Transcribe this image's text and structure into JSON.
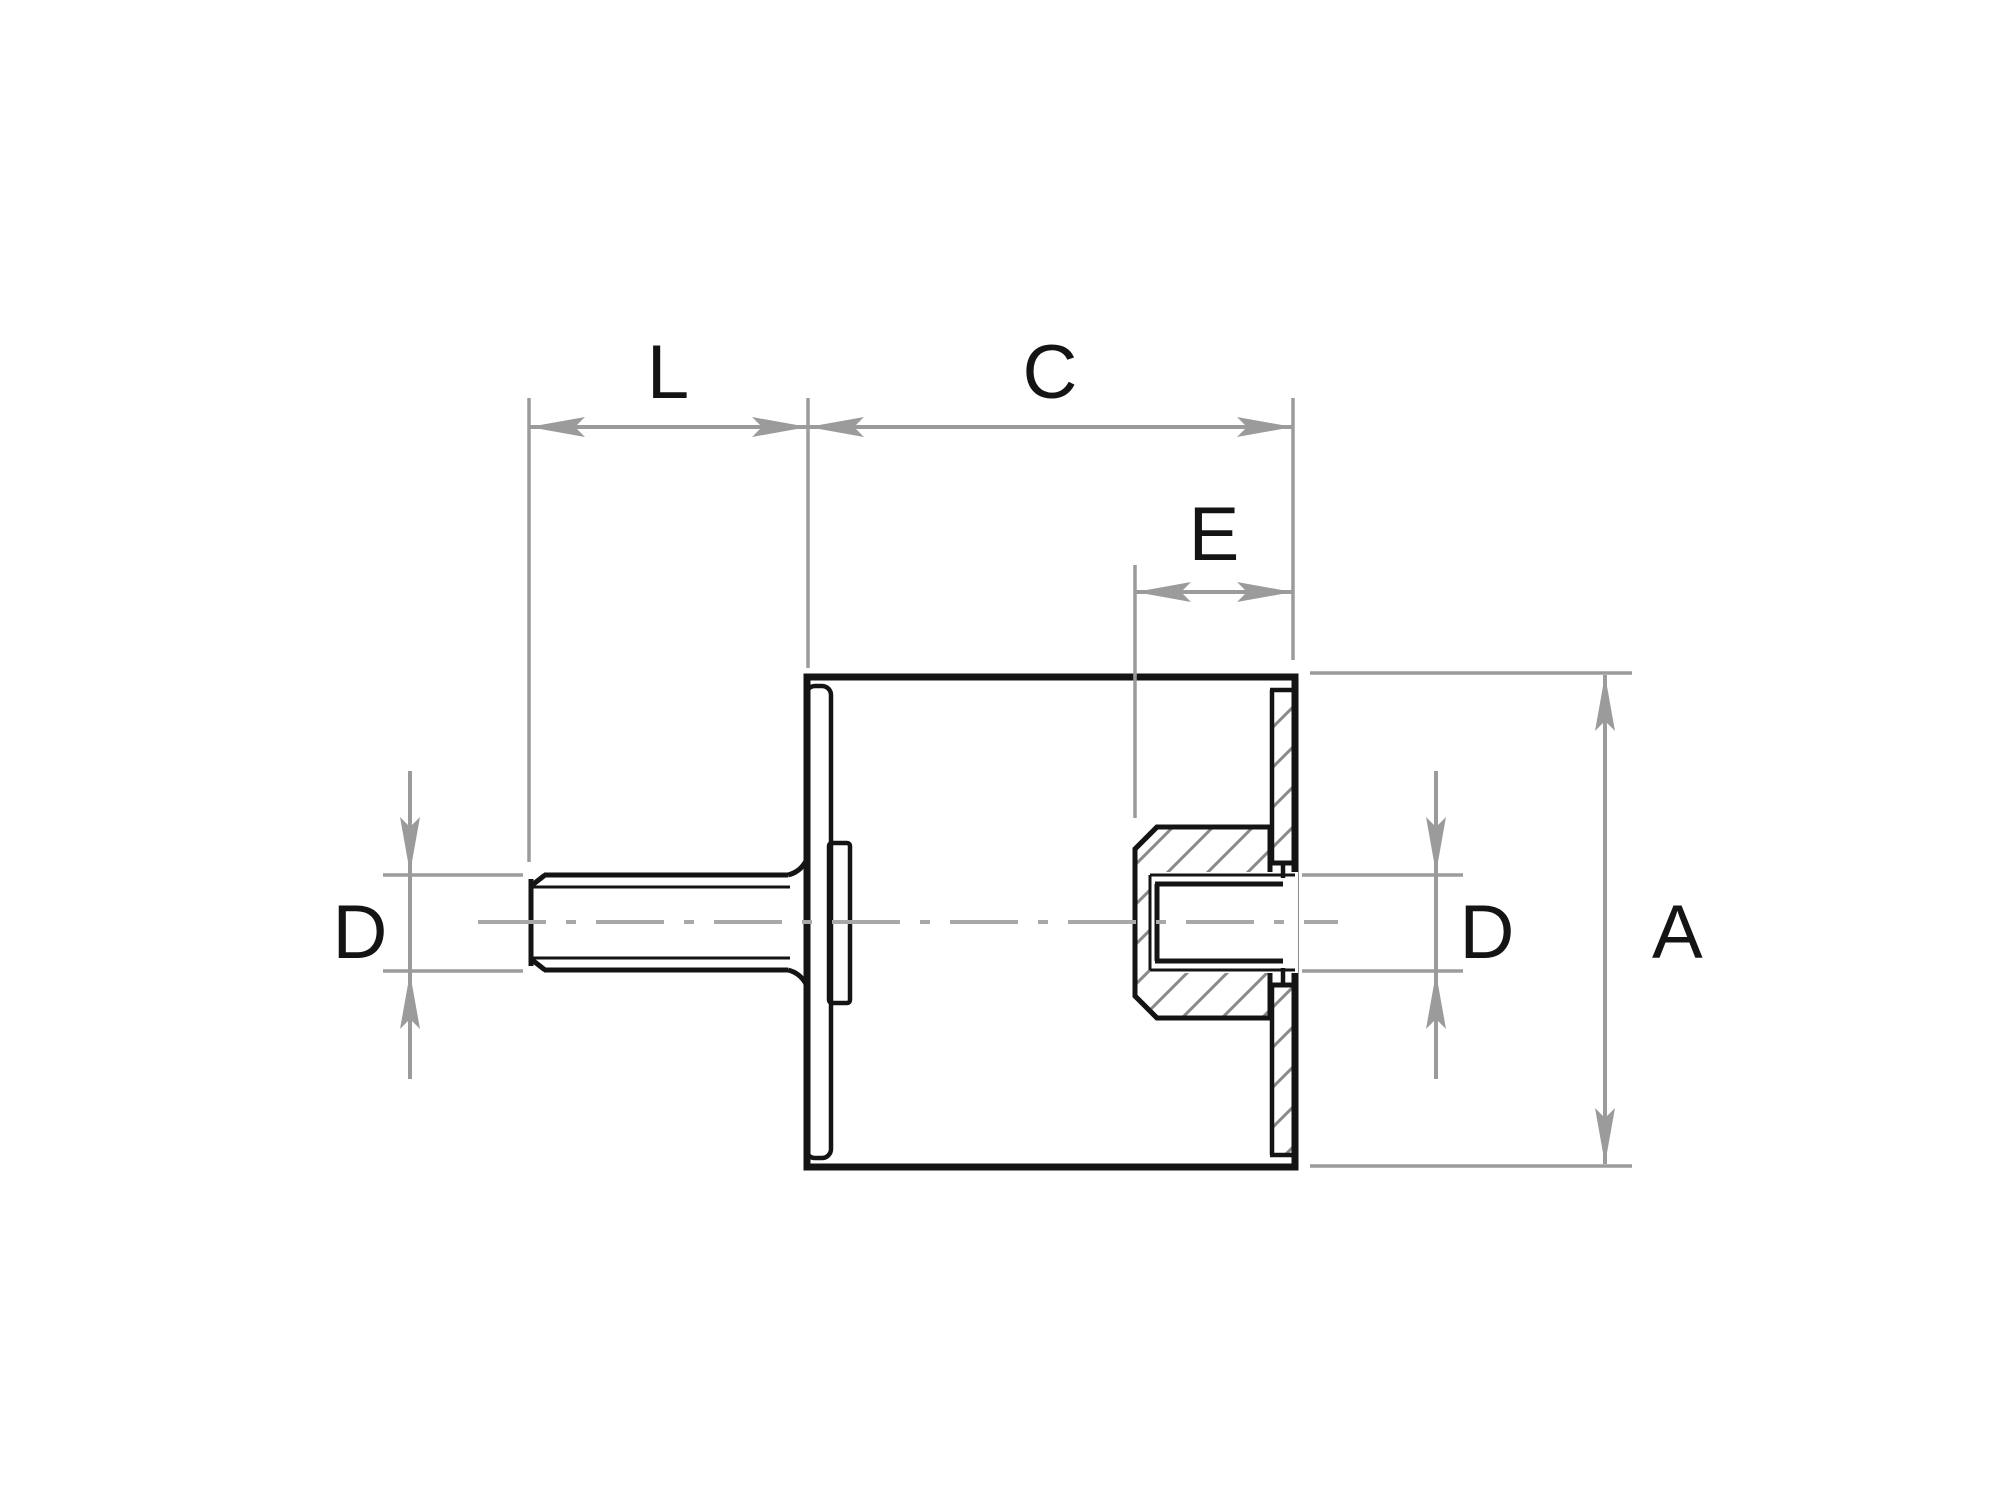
{
  "drawing": {
    "kind": "technical-section-drawing",
    "part": "cylindrical-rubber-metal-mount",
    "labels": {
      "stud_length": "L",
      "body_length": "C",
      "thread_depth": "E",
      "overall_height": "A",
      "stud_diameter": "D",
      "hole_diameter": "D"
    },
    "colors": {
      "outline": "#141414",
      "rubber-fill": "#e3e3e3",
      "dimension": "#9b9b9b",
      "centerline": "#a8a8a8",
      "hatch": "#8a8a8a",
      "background": "#ffffff"
    }
  }
}
